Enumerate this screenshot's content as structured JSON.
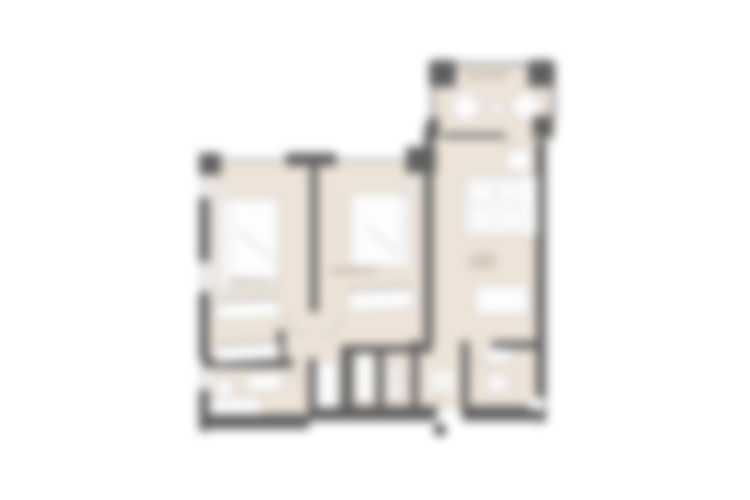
{
  "title": "Apartment floor plan",
  "colors": {
    "background": "#ffffff",
    "floor": "#ede3d8",
    "wall": "#5f5f5f",
    "railing": "#9b9b9b",
    "fixture_fill": "#fdfdfd",
    "fixture_border": "#b5b5b5",
    "label": "#8d8174",
    "entry_marker": "#3d3d3d"
  },
  "rooms": {
    "balcony": {
      "label": "BALCONY"
    },
    "bedroom_1": {
      "label": "BEDROOM 1"
    },
    "bedroom_2": {
      "label": "BEDROOM 2"
    },
    "living": {
      "label_line1": "LIVING",
      "label_line2": "DINING"
    }
  }
}
